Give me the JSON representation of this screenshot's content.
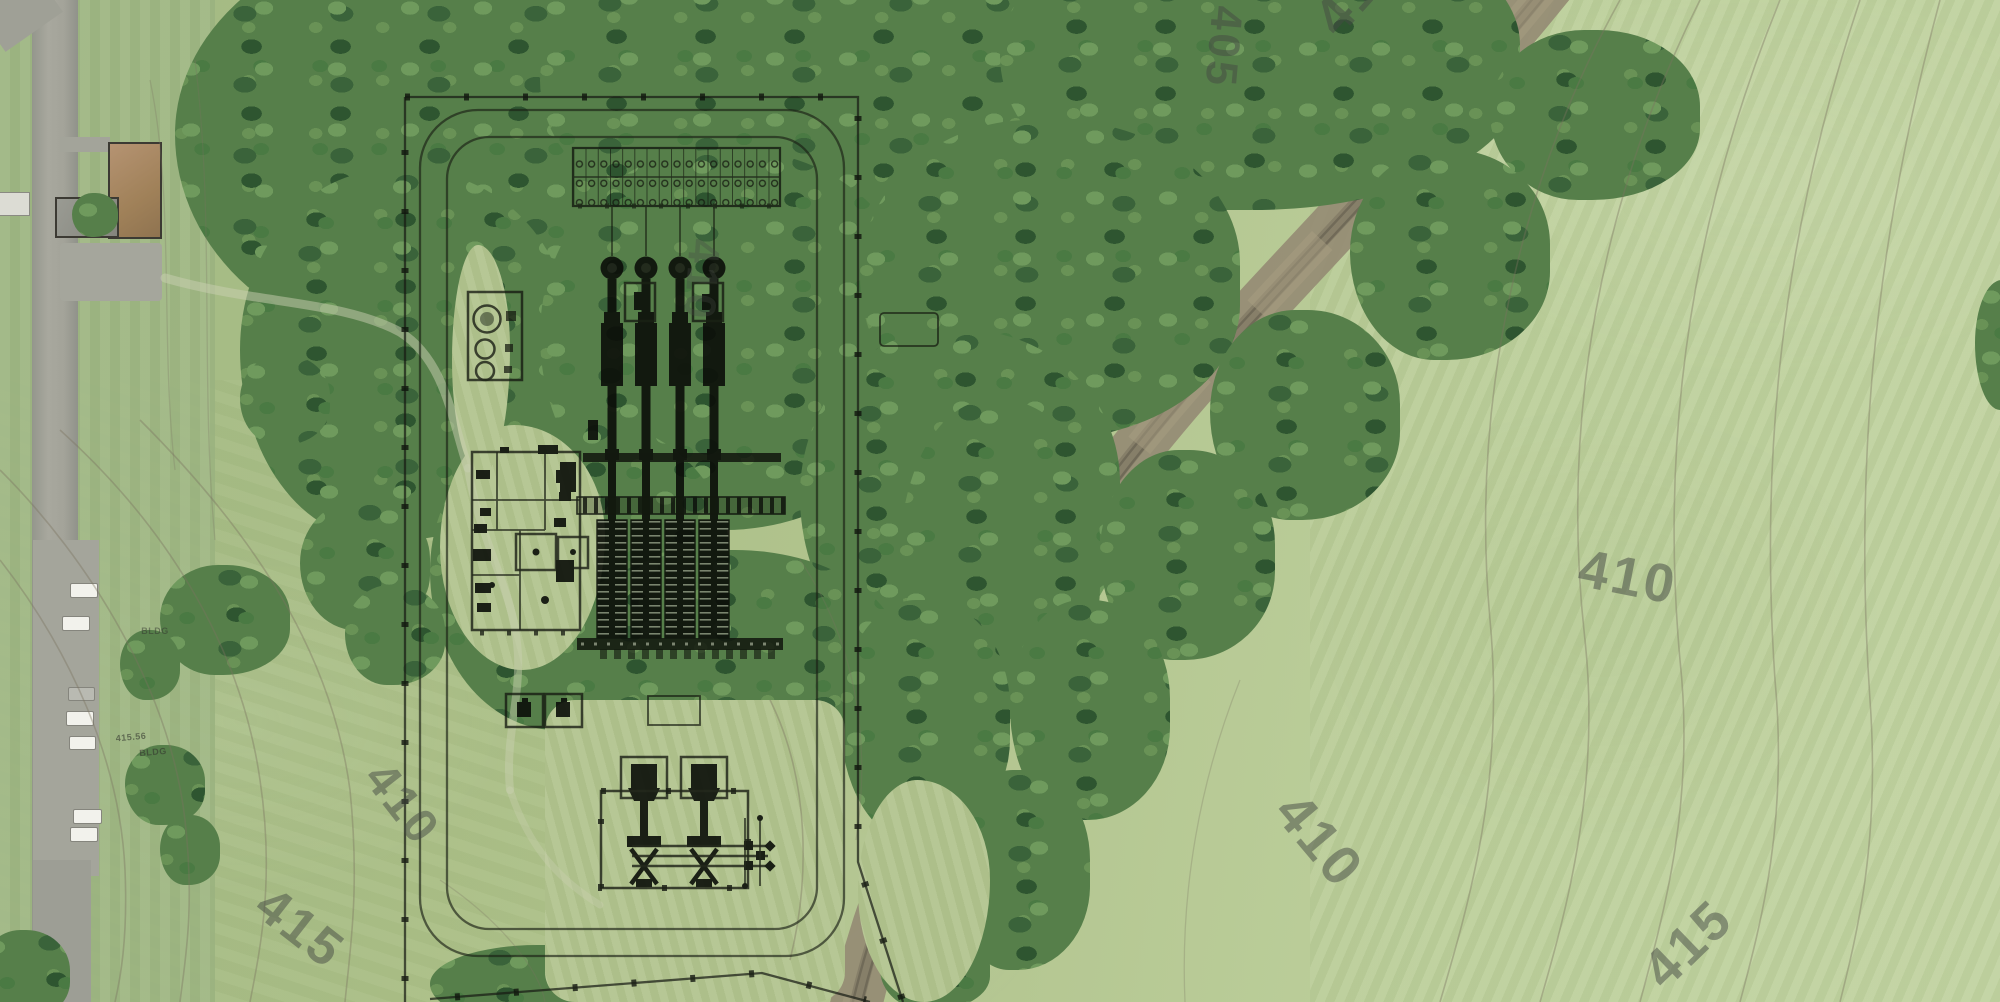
{
  "map": {
    "type": "aerial-site-plan-overlay",
    "palette": {
      "field_green": "#b3c693",
      "woods_green": "#55804a",
      "road_gray": "#a0a198",
      "corridor_tan": "#968d75",
      "plan_ink": "#14180f",
      "contour_text": "#454a44"
    },
    "contour_labels": [
      {
        "text": "405",
        "x": 1223,
        "y": 47,
        "rot": 95,
        "size": 44,
        "opacity": 0.5
      },
      {
        "text": "410",
        "x": 1358,
        "y": -10,
        "rot": -48,
        "size": 54,
        "opacity": 0.5
      },
      {
        "text": "410",
        "x": 1628,
        "y": 577,
        "rot": 11,
        "size": 54,
        "opacity": 0.52
      },
      {
        "text": "410",
        "x": 1320,
        "y": 840,
        "rot": 50,
        "size": 56,
        "opacity": 0.5
      },
      {
        "text": "415",
        "x": 1688,
        "y": 944,
        "rot": -44,
        "size": 54,
        "opacity": 0.5
      },
      {
        "text": "410",
        "x": 402,
        "y": 804,
        "rot": 52,
        "size": 48,
        "opacity": 0.5
      },
      {
        "text": "415",
        "x": 300,
        "y": 928,
        "rot": 38,
        "size": 52,
        "opacity": 0.5
      },
      {
        "text": "410",
        "x": 701,
        "y": 280,
        "rot": 94,
        "size": 44,
        "opacity": 0.32
      }
    ],
    "annotations": [
      {
        "text": "415.56",
        "x": 131,
        "y": 737,
        "rot": -5,
        "size": 9,
        "opacity": 0.6
      },
      {
        "text": "BLDG",
        "x": 153,
        "y": 752,
        "rot": -5,
        "size": 9,
        "opacity": 0.6
      },
      {
        "text": "BLDG",
        "x": 155,
        "y": 631,
        "rot": 0,
        "size": 9,
        "opacity": 0.5
      }
    ]
  }
}
